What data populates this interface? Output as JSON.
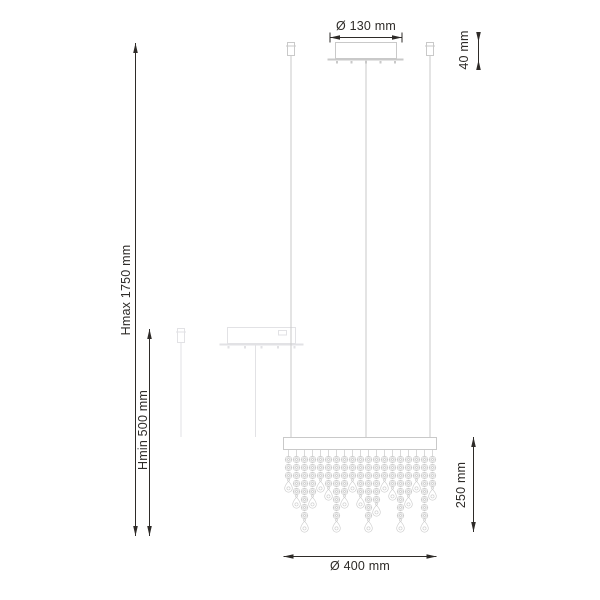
{
  "labels": {
    "hmax": "Hmax 1750 mm",
    "hmin": "Hmin 500 mm",
    "canopy_diameter": "Ø 130 mm",
    "canopy_height": "40 mm",
    "crystal_curtain_height": "250 mm",
    "lamp_diameter": "Ø 400 mm"
  },
  "colors": {
    "dimension": "#2e2b28",
    "lamp_outline": "#c9c9c9",
    "ghost_outline": "#e2e2e5"
  },
  "lamp": {
    "strand_count": 19,
    "strand_beads": [
      3,
      5,
      8,
      5,
      3,
      4,
      8,
      5,
      3,
      5,
      8,
      6,
      3,
      4,
      8,
      5,
      3,
      8,
      4
    ]
  }
}
